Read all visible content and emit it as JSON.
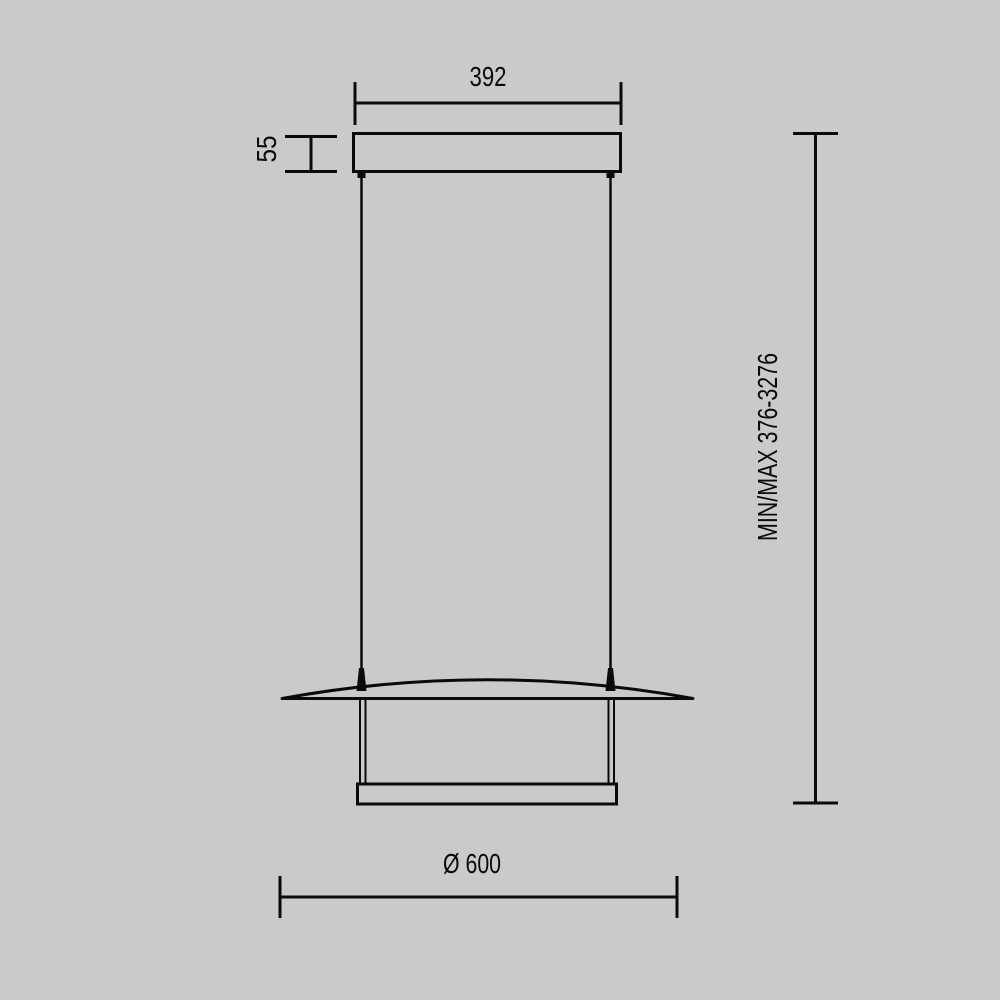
{
  "drawing": {
    "type": "technical-dimension-drawing",
    "subject": "linear pendant lamp - front elevation",
    "colors": {
      "background": "#cacaca",
      "line": "#0a0a0a"
    },
    "labels": {
      "canopy_width": "392",
      "canopy_height": "55",
      "suspension_range": "MIN/MAX 376-3276",
      "shade_diameter": "Ø 600"
    }
  }
}
